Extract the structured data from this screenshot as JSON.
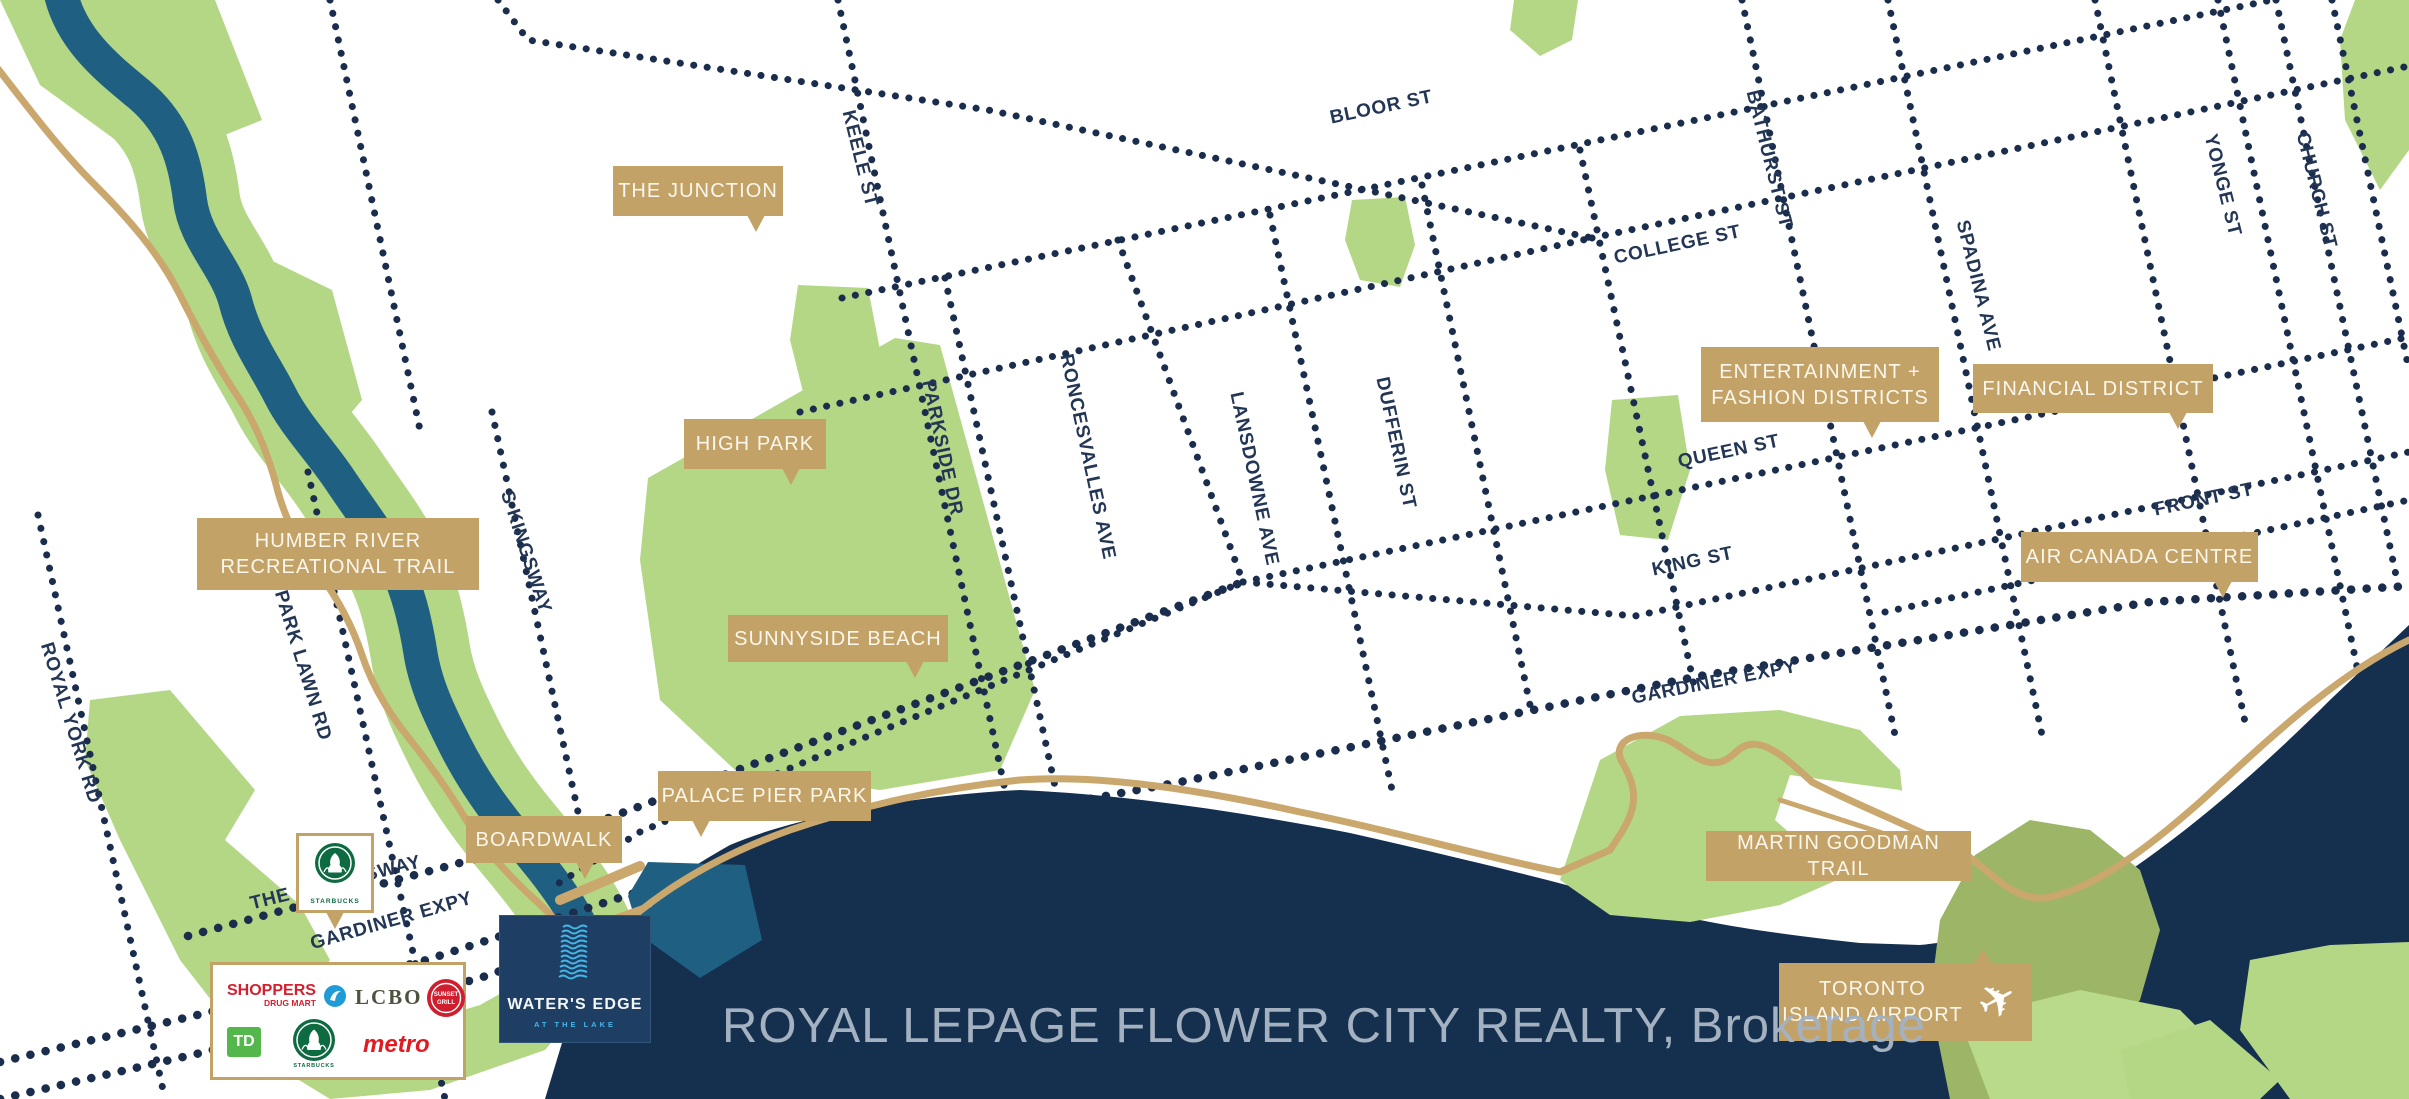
{
  "map": {
    "title": "Water's Edge neighbourhood map, Toronto waterfront",
    "colors": {
      "lake": "#14304e",
      "river": "#1f5f82",
      "park_green": "#b4d786",
      "island_olive": "#9db566",
      "island_light": "#b9da8b",
      "road_dots": "#1b2d4d",
      "trail_tan": "#c9a76d",
      "callout_bg": "#c3a267",
      "callout_text": "#fbf7ec"
    },
    "callouts": [
      {
        "id": "the-junction",
        "text": "THE JUNCTION"
      },
      {
        "id": "high-park",
        "text": "HIGH PARK"
      },
      {
        "id": "humber-river-trail",
        "text": "HUMBER RIVER\nRECREATIONAL  TRAIL"
      },
      {
        "id": "sunnyside-beach",
        "text": "SUNNYSIDE BEACH"
      },
      {
        "id": "palace-pier-park",
        "text": "PALACE PIER PARK"
      },
      {
        "id": "boardwalk",
        "text": "BOARDWALK"
      },
      {
        "id": "entertainment-fashion",
        "text": "ENTERTAINMENT +\nFASHION DISTRICTS"
      },
      {
        "id": "financial-district",
        "text": "FINANCIAL DISTRICT"
      },
      {
        "id": "air-canada-centre",
        "text": "AIR CANADA CENTRE"
      },
      {
        "id": "martin-goodman-trail",
        "text": "MARTIN GOODMAN TRAIL"
      },
      {
        "id": "toronto-island-airport",
        "text": "TORONTO\nISLAND AIRPORT"
      }
    ],
    "streets": [
      {
        "name": "KEELE ST"
      },
      {
        "name": "BLOOR ST"
      },
      {
        "name": "BATHURST ST"
      },
      {
        "name": "COLLEGE ST"
      },
      {
        "name": "SPADINA AVE"
      },
      {
        "name": "YONGE ST"
      },
      {
        "name": "CHURCH ST"
      },
      {
        "name": "PARKSIDE DR"
      },
      {
        "name": "RONCESVALLES AVE"
      },
      {
        "name": "LANSDOWNE AVE"
      },
      {
        "name": "DUFFERIN ST"
      },
      {
        "name": "QUEEN ST"
      },
      {
        "name": "KING ST"
      },
      {
        "name": "FRONT ST"
      },
      {
        "name": "GARDINER EXPY"
      },
      {
        "name": "GARDINER EXPY"
      },
      {
        "name": "THE QUEENSWAY"
      },
      {
        "name": "S KINGSWAY"
      },
      {
        "name": "PARK LAWN RD"
      },
      {
        "name": "ROYAL YORK RD"
      }
    ]
  },
  "markers": {
    "starbucks": {
      "label": "STARBUCKS"
    },
    "waters_edge": {
      "name": "WATER'S EDGE",
      "tagline": "AT THE LAKE"
    },
    "retail": {
      "shoppers_line1": "SHOPPERS",
      "shoppers_line2": "DRUG MART",
      "lcbo": "LCBO",
      "sunset_grill_line1": "SUNSET",
      "sunset_grill_line2": "GRILL",
      "td": "TD",
      "starbucks": "STARBUCKS",
      "metro": "metro"
    }
  },
  "footer": {
    "brokerage": "ROYAL LEPAGE FLOWER CITY REALTY, Brokerage"
  }
}
